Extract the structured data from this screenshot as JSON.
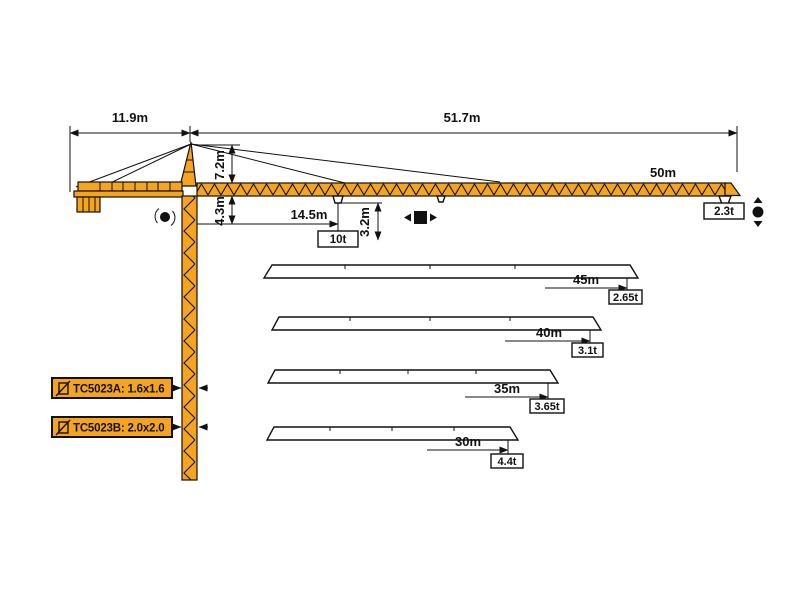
{
  "model": {
    "series_a": "TC5023A: 1.6x1.6",
    "series_b": "TC5023B: 2.0x2.0"
  },
  "dimensions": {
    "counter_jib_length": "11.9m",
    "jib_total_length": "51.7m",
    "tower_head_height": "7.2m",
    "jib_to_slew_height": "4.3m",
    "min_hook_radius": "14.5m",
    "hook_height_range": "3.2m",
    "max_capacity": "10t"
  },
  "configurations": [
    {
      "jib_length": "50m",
      "tip_load": "2.3t"
    },
    {
      "jib_length": "45m",
      "tip_load": "2.65t"
    },
    {
      "jib_length": "40m",
      "tip_load": "3.1t"
    },
    {
      "jib_length": "35m",
      "tip_load": "3.65t"
    },
    {
      "jib_length": "30m",
      "tip_load": "4.4t"
    }
  ],
  "colors": {
    "crane_orange": "#F5A41F",
    "outline": "#111111"
  }
}
